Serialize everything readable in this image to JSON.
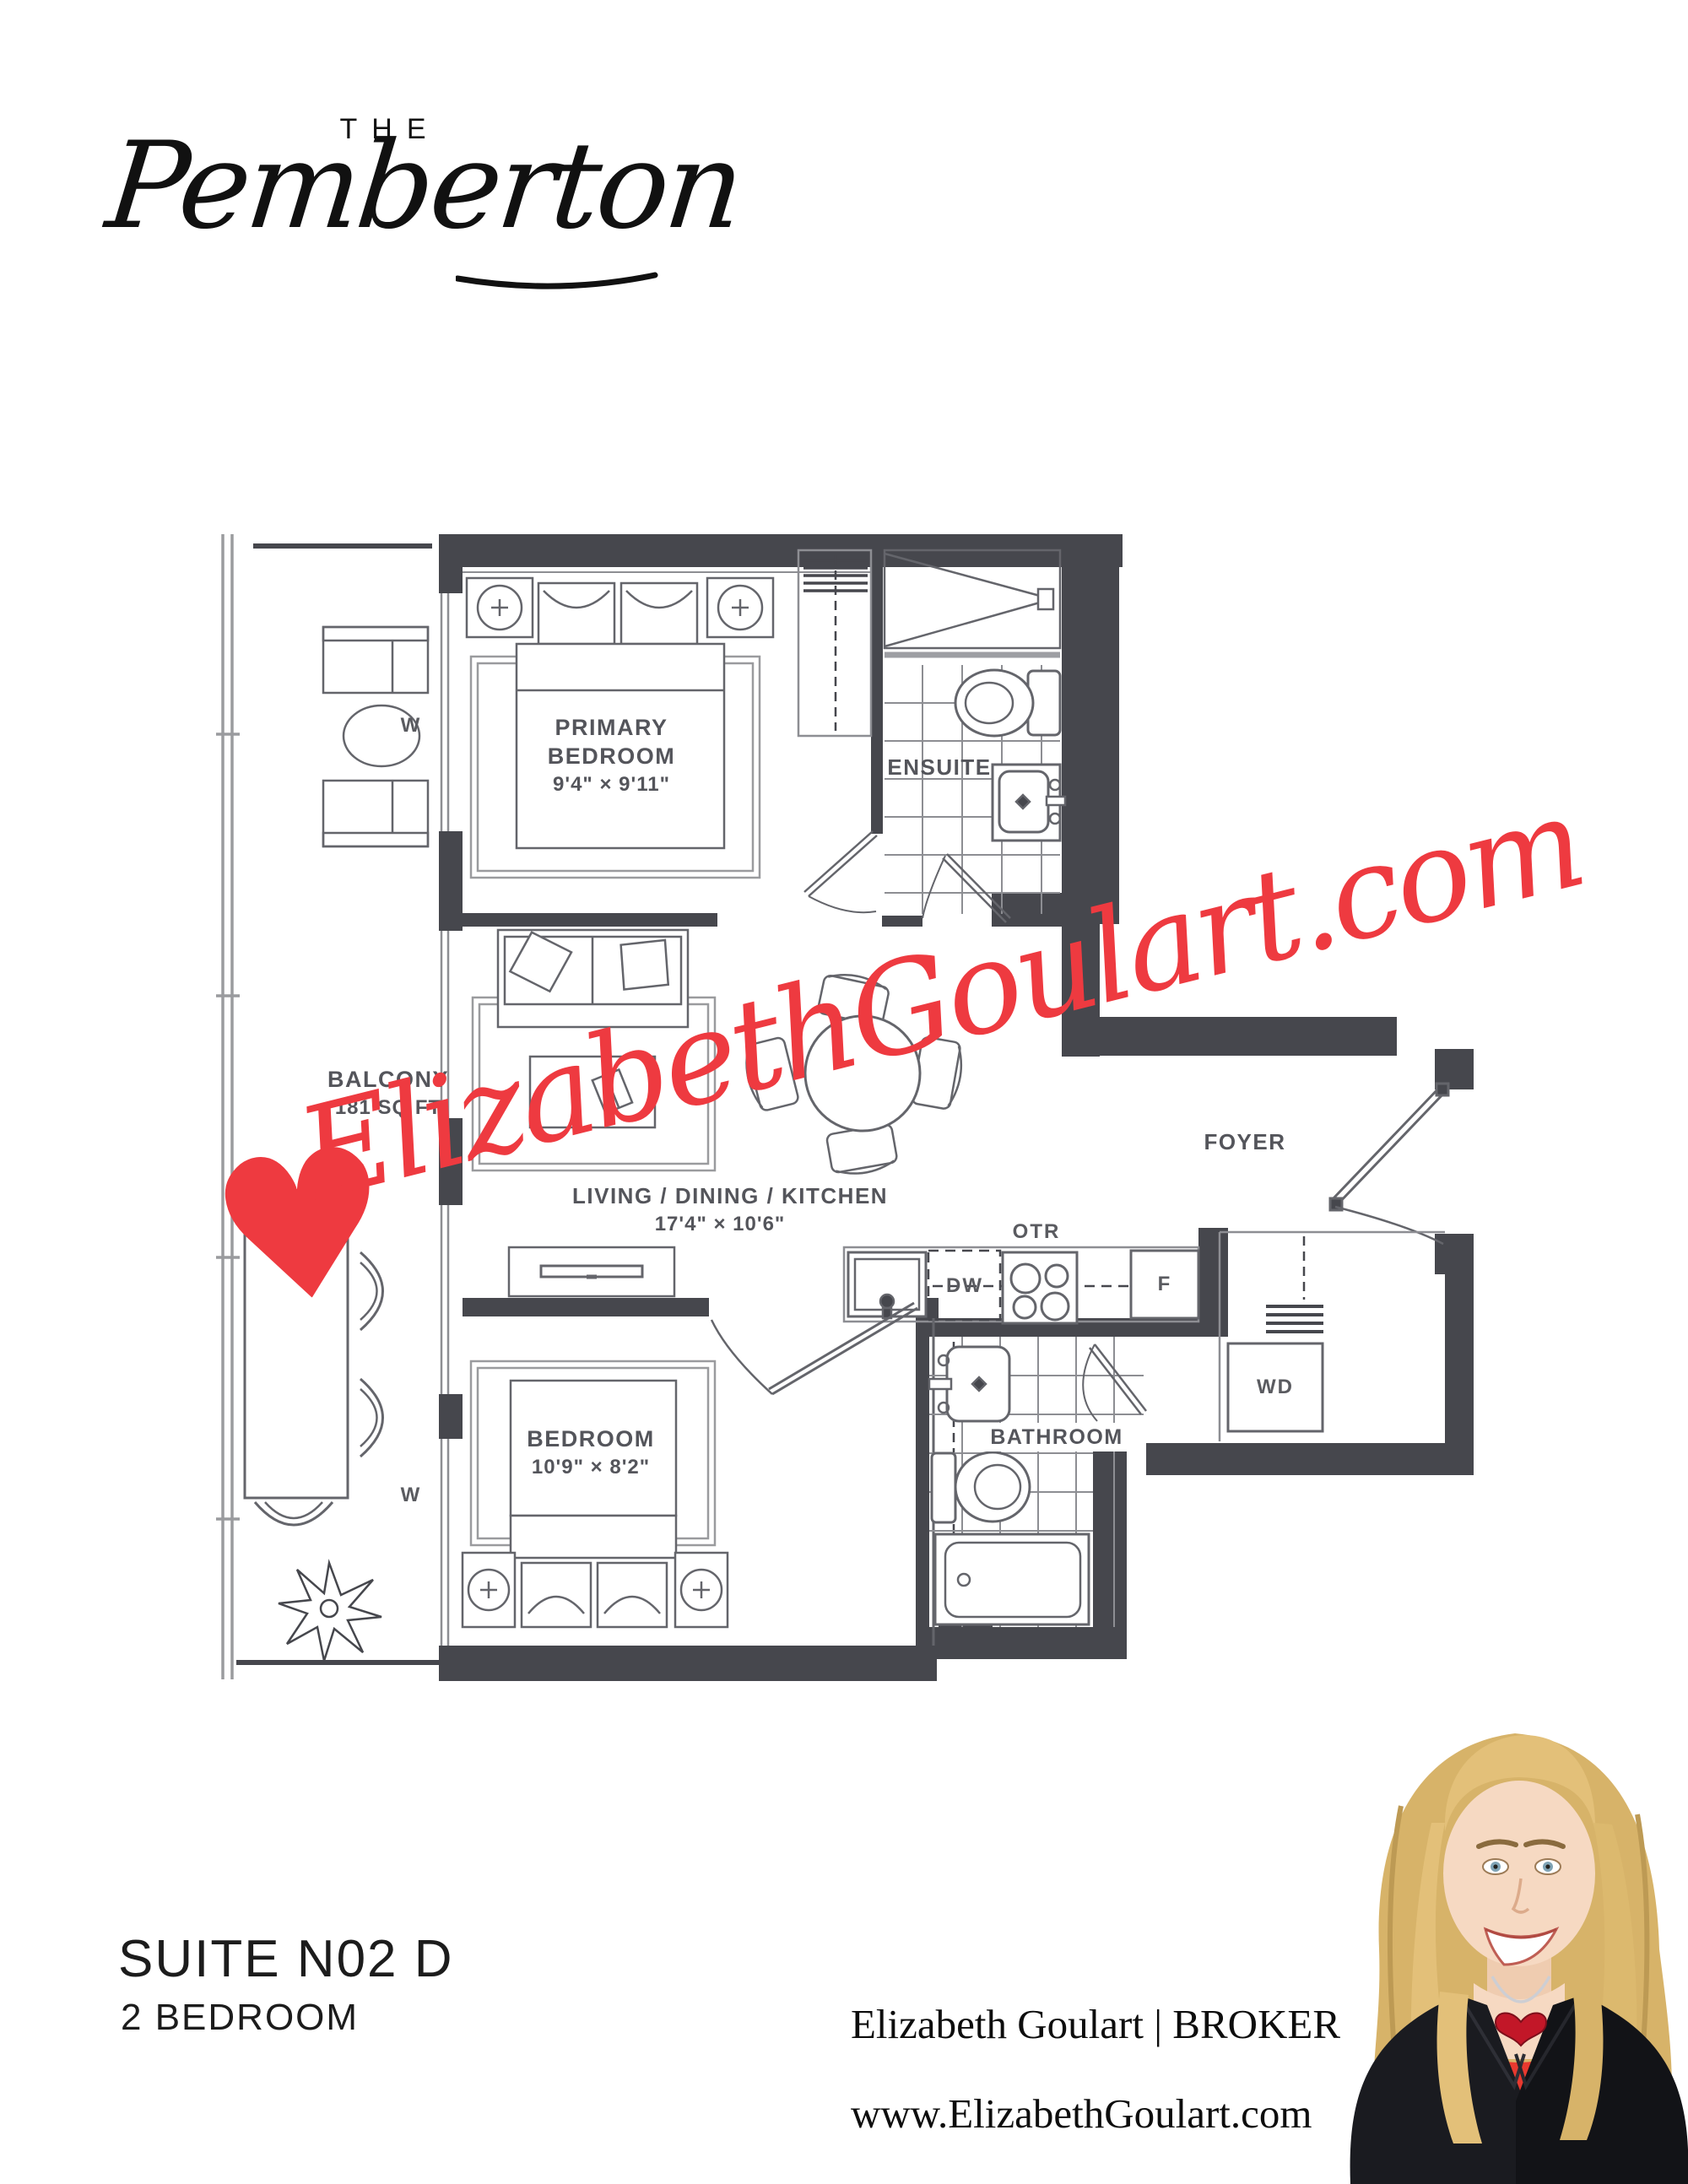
{
  "brand": {
    "pre": "THE",
    "name": "Pemberton"
  },
  "watermark": {
    "heart": "♥",
    "text": "ElizabethGoulart.com"
  },
  "colors": {
    "watermark_red": "#ee3a40",
    "wall": "#46474d"
  },
  "plan": {
    "primary_bedroom": {
      "l1": "PRIMARY",
      "l2": "BEDROOM",
      "dims": "9'4\" × 9'11\""
    },
    "bedroom": {
      "l1": "BEDROOM",
      "dims": "10'9\" × 8'2\""
    },
    "living": {
      "l1": "LIVING / DINING / KITCHEN",
      "dims": "17'4\" × 10'6\""
    },
    "balcony": {
      "l1": "BALCONY",
      "l2": "181 SQ FT"
    },
    "ensuite": "ENSUITE",
    "bathroom": "BATHROOM",
    "foyer": "FOYER",
    "appliances": {
      "otr": "OTR",
      "dw": "DW",
      "fridge": "F",
      "wd": "WD"
    },
    "window_marker": "W"
  },
  "footer": {
    "suite": "SUITE N02 D",
    "type": "2 BEDROOM",
    "agent": "Elizabeth Goulart | BROKER",
    "website": "www.ElizabethGoulart.com"
  }
}
